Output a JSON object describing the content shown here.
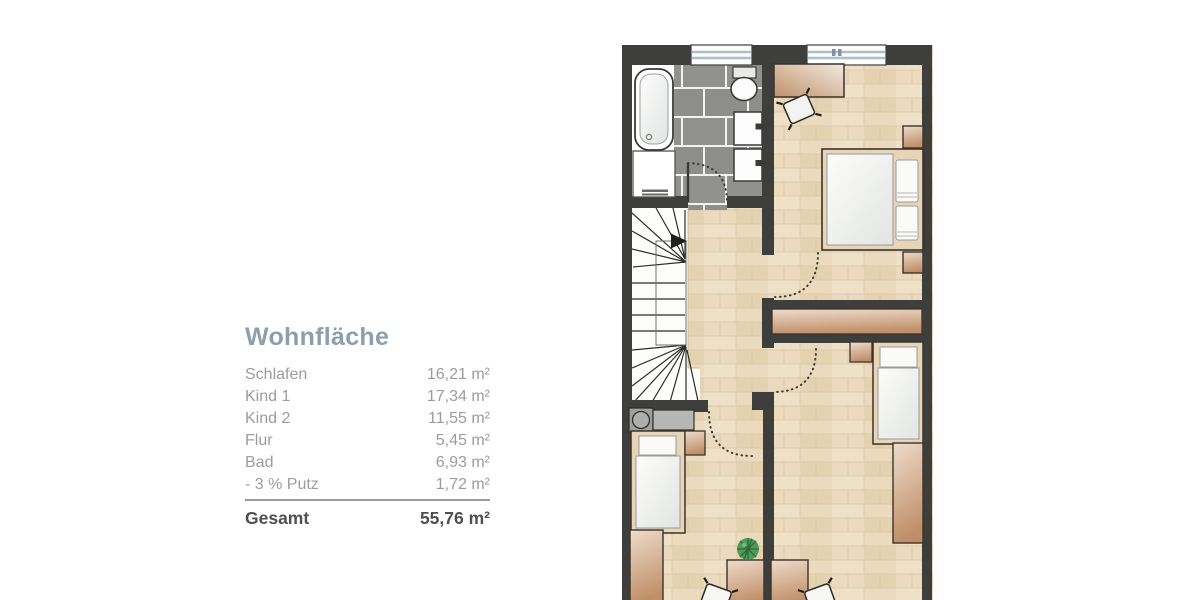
{
  "legend": {
    "title": "Wohnfläche",
    "rows": [
      {
        "label": "Schlafen",
        "value": "16,21 m²"
      },
      {
        "label": "Kind 1",
        "value": "17,34 m²"
      },
      {
        "label": "Kind 2",
        "value": "11,55 m²"
      },
      {
        "label": "Flur",
        "value": "5,45 m²"
      },
      {
        "label": "Bad",
        "value": "6,93 m²"
      },
      {
        "label": "- 3 % Putz",
        "value": "1,72 m²"
      }
    ],
    "total": {
      "label": "Gesamt",
      "value": "55,76 m²"
    }
  },
  "floorplan": {
    "type": "upper-floor apartment plan, bottom edge cropped",
    "rooms": [
      "Bad",
      "Schlafen",
      "Flur",
      "Kind 1",
      "Kind 2"
    ],
    "features": [
      "bathtub",
      "toilet",
      "two-washbasins",
      "winder-staircase",
      "stair-direction-arrow",
      "double-bed",
      "two-single-beds",
      "desks-with-chairs",
      "wardrobes",
      "nightstands",
      "plant",
      "two-top-windows",
      "dotted-door-swings"
    ],
    "colors": {
      "wall": "#3e3e3c",
      "wood_floor": "#ebdabd",
      "tile_floor": "#8e8e8c",
      "furniture_wood_dark": "#c08f69",
      "furniture_wood_light": "#eedccb",
      "window_glazing": "#aabfcb",
      "plant_green": "#4f9a5c",
      "title_text": "#8aa1ad",
      "row_text": "#9c9c9c",
      "total_text": "#4f4f4f"
    }
  }
}
